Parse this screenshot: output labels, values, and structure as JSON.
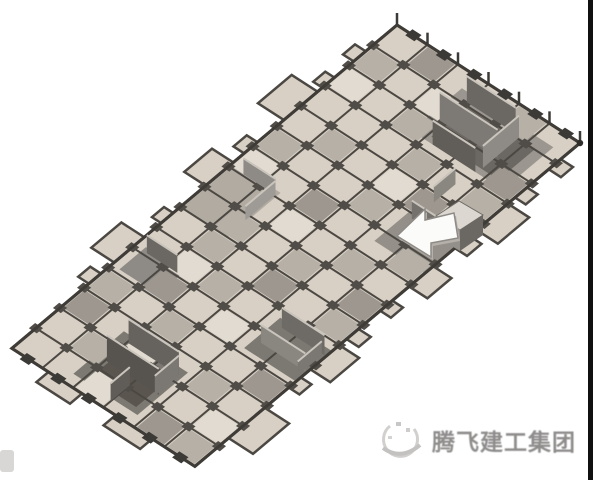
{
  "watermark": {
    "company_name": "腾飞建工集团",
    "logo_icon": "swoosh-globe-icon"
  },
  "colors": {
    "background": "#ffffff",
    "slab_panel": "#d8d0c5",
    "slab_panel_light": "#e2dbd1",
    "slab_panel_medium": "#b7b0a7",
    "slab_panel_shaded": "#9d978f",
    "beam_grid": "#4b4742",
    "outline": "#3f3c38",
    "wall_dark": "#6b6762",
    "wall_medium": "#8e8a85",
    "watermark_text": "#8f8d8c",
    "right_bar": "#101010"
  }
}
